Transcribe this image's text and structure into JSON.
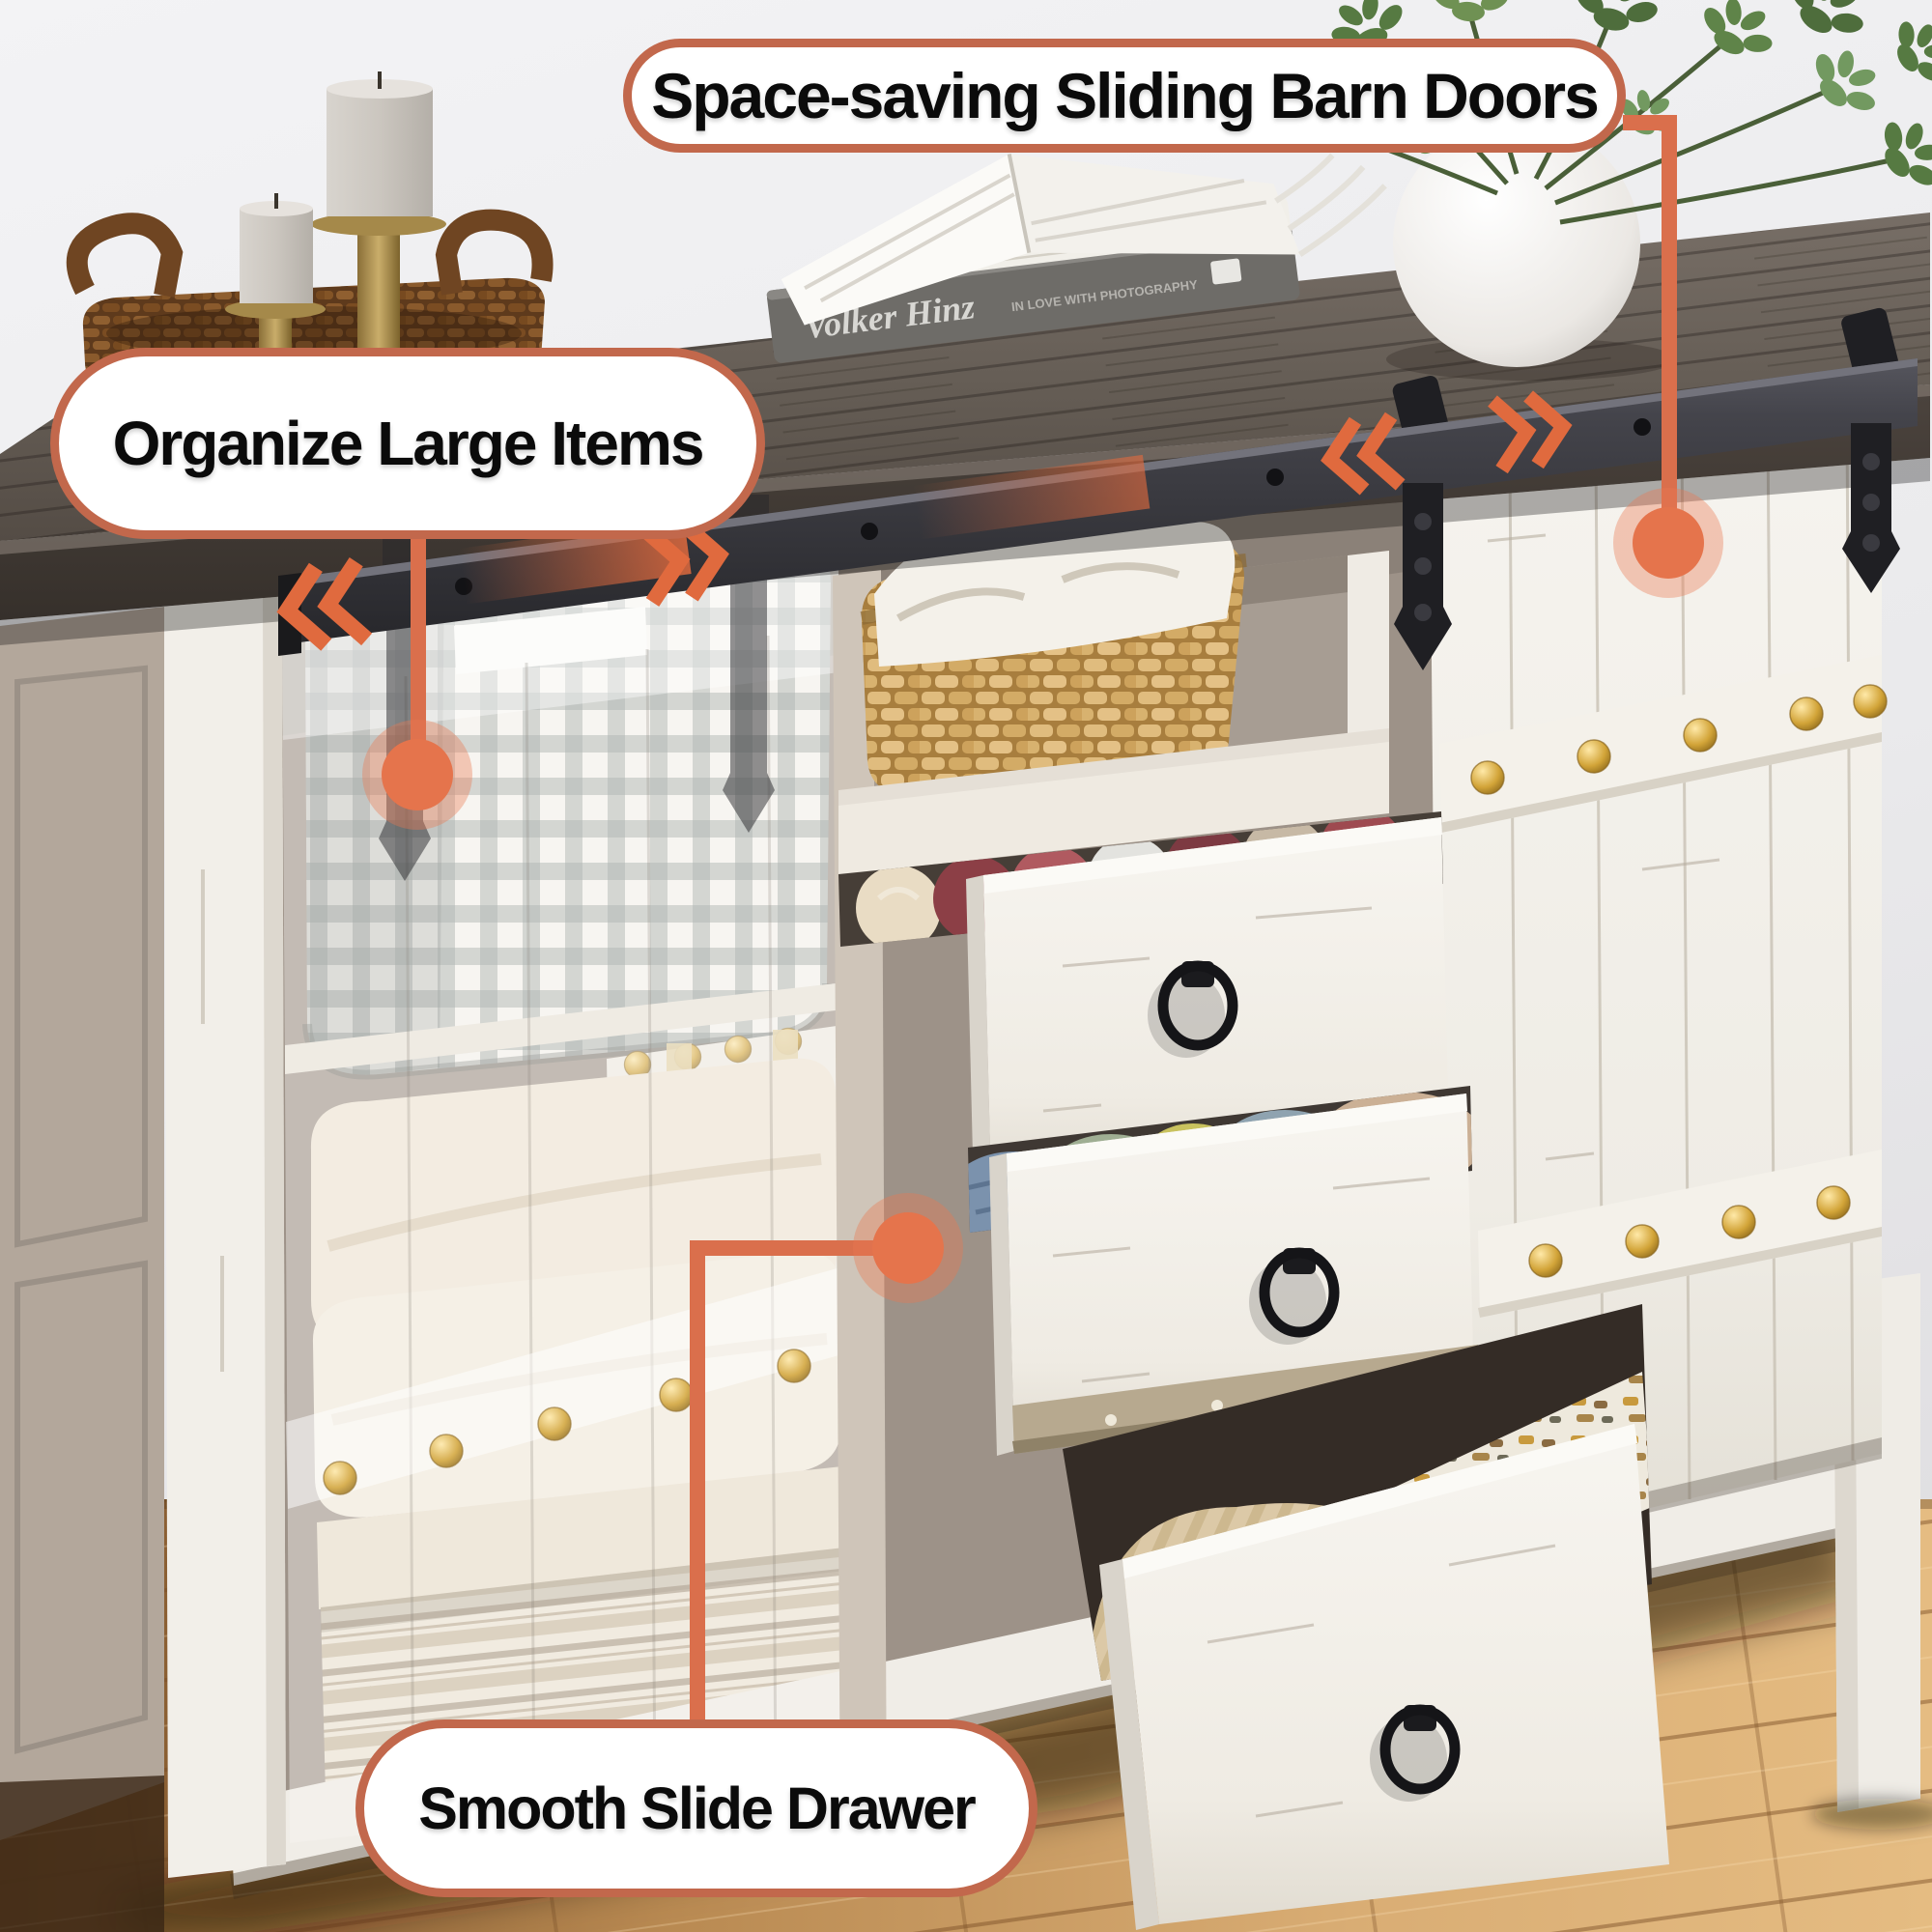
{
  "callouts": {
    "barn_doors": {
      "label": "Space-saving Sliding Barn Doors"
    },
    "large_items": {
      "label": "Organize Large Items"
    },
    "slide_drawer": {
      "label": "Smooth Slide Drawer"
    }
  },
  "decor": {
    "book_spine_title": "Volker Hinz",
    "book_spine_subtitle": "IN LOVE WITH PHOTOGRAPHY"
  },
  "colors": {
    "callout_border": "#c2684c",
    "connector": "#da6f4c",
    "dot": "#e5744c",
    "dot_halo": "rgba(233,122,82,0.38)",
    "rail_metal": "#3a3a40",
    "arrow_orange": "#e06a3e",
    "tabletop_wood": "#665e56",
    "cabinet_white": "#f2efe9",
    "stud_gold": "#d2a438",
    "floor_wood": "#d4a76f"
  }
}
